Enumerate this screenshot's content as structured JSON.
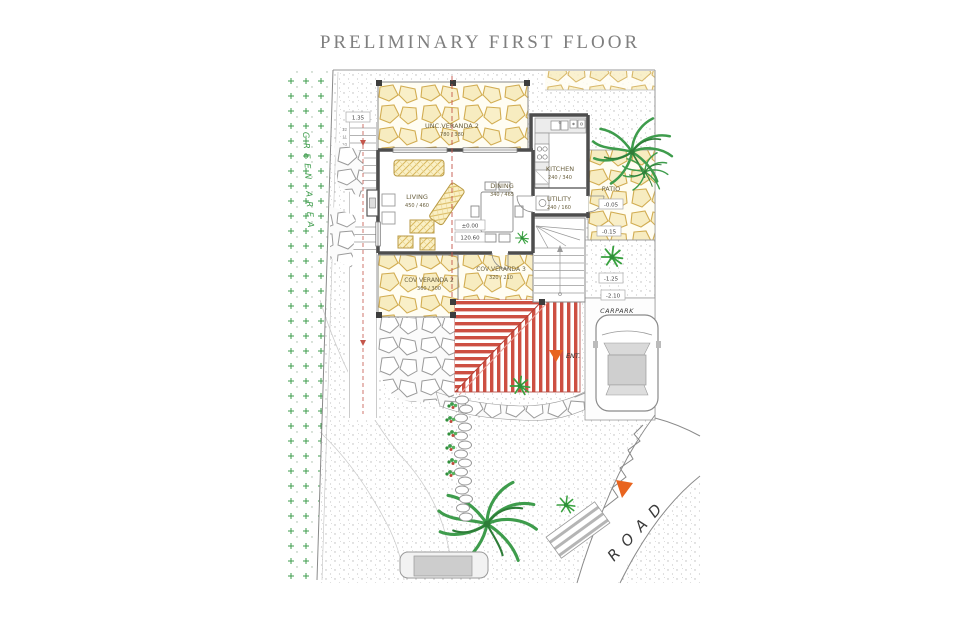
{
  "page": {
    "title": "PRELIMINARY FIRST FLOOR"
  },
  "rooms": {
    "unc_veranda_2": {
      "name": "UNC.VERANDA 2",
      "dims": "780 / 380"
    },
    "kitchen": {
      "name": "KITCHEN",
      "dims": "240 / 340"
    },
    "utility": {
      "name": "UTILITY",
      "dims": "240 / 160"
    },
    "dining": {
      "name": "DINING",
      "dims": "340 / 465"
    },
    "living": {
      "name": "LIVING",
      "dims": "450 / 460"
    },
    "cov_veranda_2": {
      "name": "COV VERANDA 2",
      "dims": "360 / 300"
    },
    "cov_veranda_3": {
      "name": "COV VERANDA 3",
      "dims": "320 / 210"
    },
    "patio": {
      "name": "PATIO",
      "level": "-0.05"
    },
    "carpark": {
      "name": "CARPARK",
      "level": "-2.10"
    }
  },
  "levels": {
    "floor": "±0.00",
    "floor_abs": "120.60",
    "terrace": "1.35",
    "garden_upper": "-0.15",
    "garden_lower": "-1.25"
  },
  "labels": {
    "entrance": "ENT.",
    "road": "ROAD",
    "green_area": "GREEN AREA"
  },
  "steps_upper": [
    "12",
    "11",
    "10",
    "09",
    "08",
    "07"
  ],
  "steps_lower": [
    "03",
    "02",
    "01"
  ],
  "colors": {
    "veranda_stone": "#d2ad52",
    "roof_stripe": "#cd4f42",
    "vegetation": "#3e9c4c",
    "marker": "#e8641f",
    "walls": "#4d4d4d",
    "title": "#7f7f7f"
  }
}
